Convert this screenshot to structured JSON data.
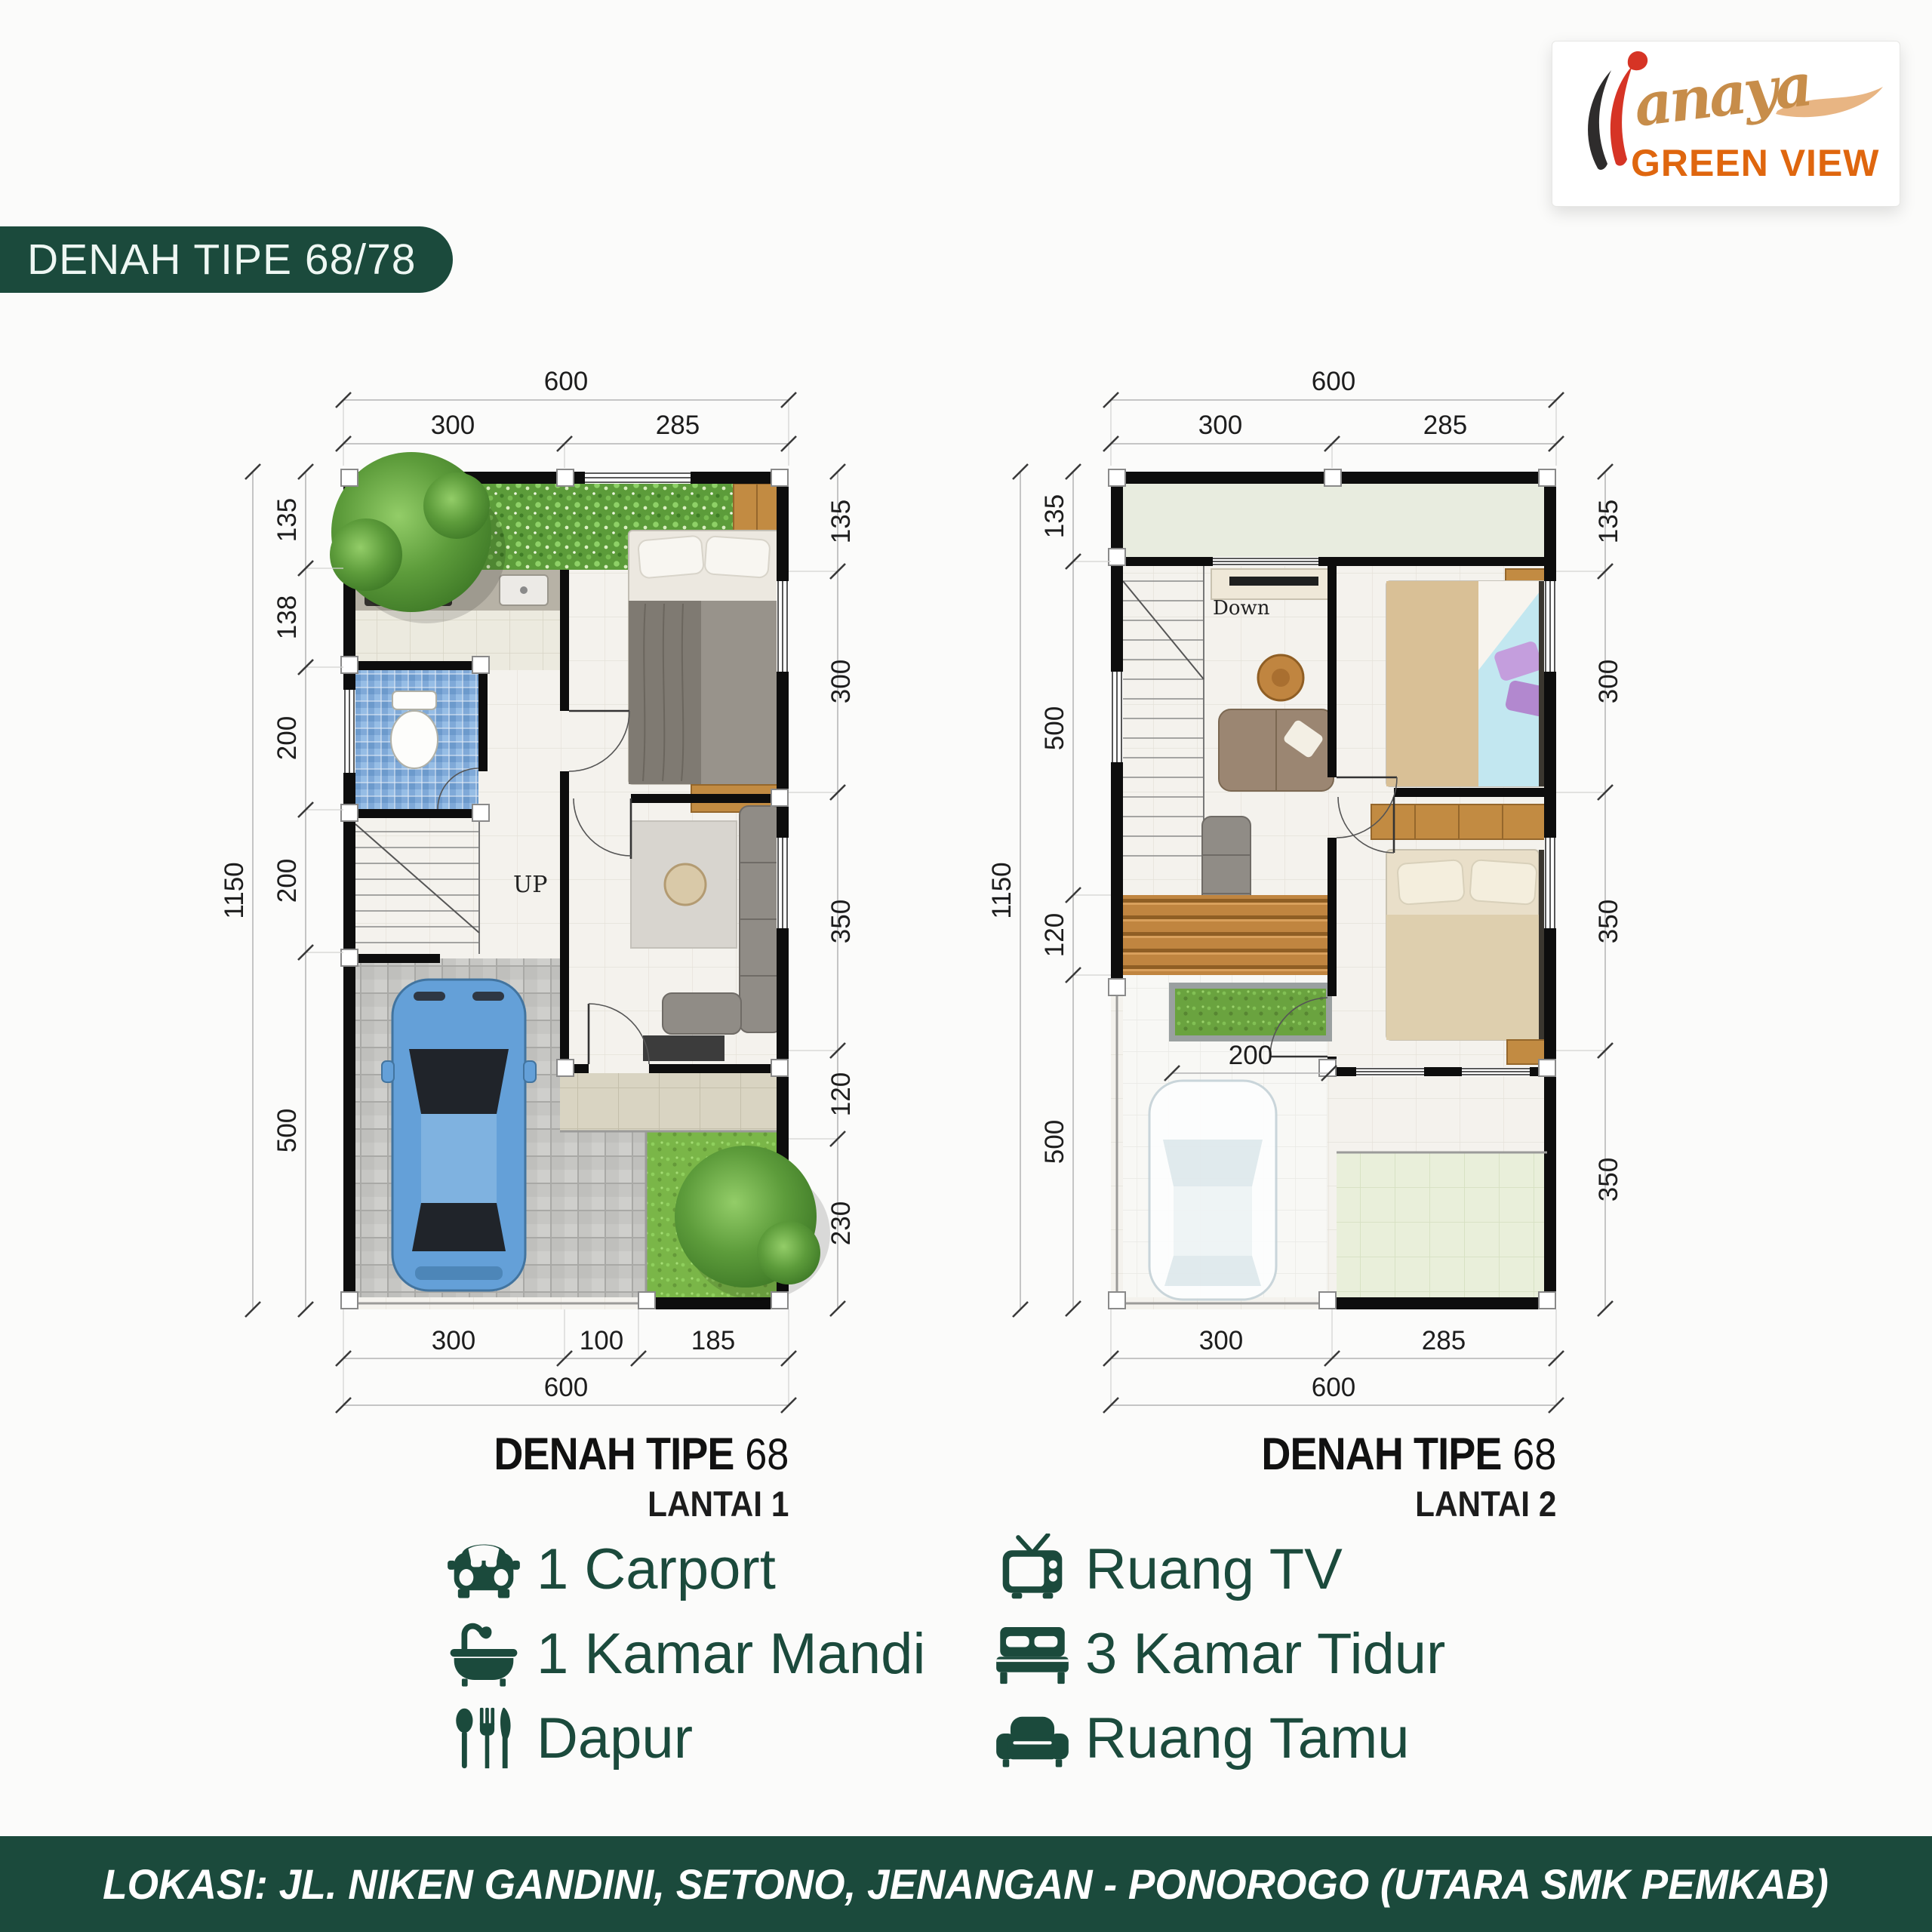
{
  "logo": {
    "script": "anaya",
    "main": "GREEN VIEW"
  },
  "header_badge": {
    "label": "DENAH TIPE 68/78"
  },
  "plan1": {
    "title": "DENAH TIPE",
    "title_number": "68",
    "subtitle": "LANTAI 1",
    "stairs_label": "UP",
    "dims": {
      "top_overall": "600",
      "top_seg": [
        "300",
        "285"
      ],
      "left_overall": "1150",
      "left_seg": [
        "135",
        "138",
        "200",
        "200",
        "500"
      ],
      "right_seg": [
        "135",
        "300",
        "350",
        "120",
        "230"
      ],
      "bottom_seg": [
        "300",
        "100",
        "185"
      ],
      "bottom_overall": "600"
    }
  },
  "plan2": {
    "title": "DENAH TIPE",
    "title_number": "68",
    "subtitle": "LANTAI 2",
    "stairs_label": "Down",
    "interior_dim": "200",
    "dims": {
      "top_overall": "600",
      "top_seg": [
        "300",
        "285"
      ],
      "left_overall": "1150",
      "left_seg": [
        "135",
        "500",
        "120",
        "500"
      ],
      "right_seg": [
        "135",
        "300",
        "350",
        "350"
      ],
      "bottom_seg": [
        "300",
        "285"
      ],
      "bottom_overall": "600"
    }
  },
  "features": {
    "left": [
      {
        "icon": "car-icon",
        "label": "1 Carport"
      },
      {
        "icon": "bathtub-icon",
        "label": "1 Kamar Mandi"
      },
      {
        "icon": "cutlery-icon",
        "label": "Dapur"
      }
    ],
    "right": [
      {
        "icon": "tv-icon",
        "label": "Ruang TV"
      },
      {
        "icon": "bed-icon",
        "label": "3 Kamar Tidur"
      },
      {
        "icon": "sofa-icon",
        "label": "Ruang Tamu"
      }
    ]
  },
  "footer": {
    "location": "LOKASI: JL. NIKEN GANDINI, SETONO, JENANGAN - PONOROGO (UTARA SMK PEMKAB)"
  },
  "colors": {
    "brand_green": "#1b4a3c",
    "brand_orange": "#df660e",
    "logo_red": "#d63425",
    "logo_tan": "#c78d4a"
  }
}
